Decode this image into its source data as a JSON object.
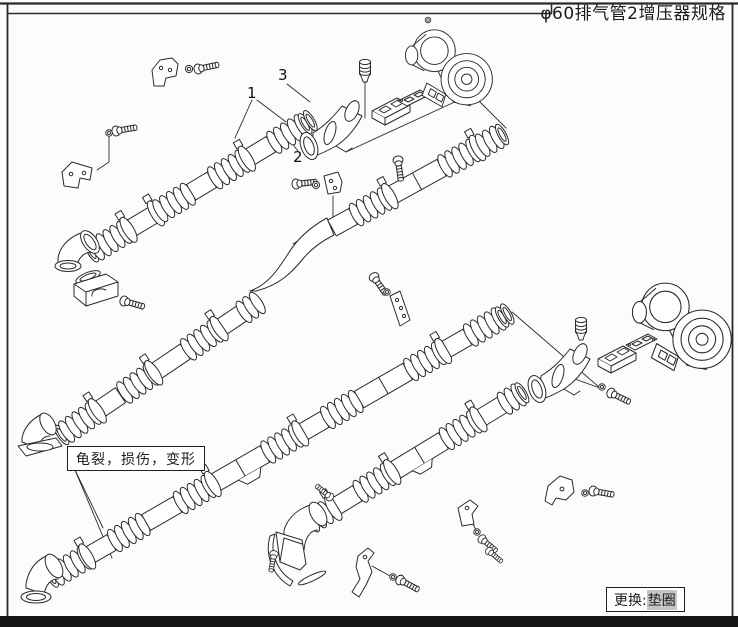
{
  "frame": {
    "background": "#fcfcfc",
    "line_color": "#2b2b2b",
    "bottom_bar_color": "#151515"
  },
  "title": {
    "text": "φ60排气管2增压器规格"
  },
  "callouts": {
    "one": "1",
    "two": "2",
    "three": "3"
  },
  "note_box": {
    "text": "龟裂，损伤，变形"
  },
  "replace_box": {
    "label": "更换:",
    "highlight": "垫圈"
  },
  "components": [
    "flexible-exhaust-pipe-upper-left",
    "flexible-exhaust-pipe-s-bend",
    "flexible-exhaust-pipe-middle",
    "flexible-exhaust-pipe-lower",
    "turbocharger-upper",
    "turbocharger-lower",
    "outlet-elbow-upper",
    "outlet-elbow-lower",
    "plug-fitting",
    "flange-block",
    "gasket-plate",
    "end-elbow-with-flange",
    "clamp-bracket",
    "bolt",
    "washer"
  ]
}
